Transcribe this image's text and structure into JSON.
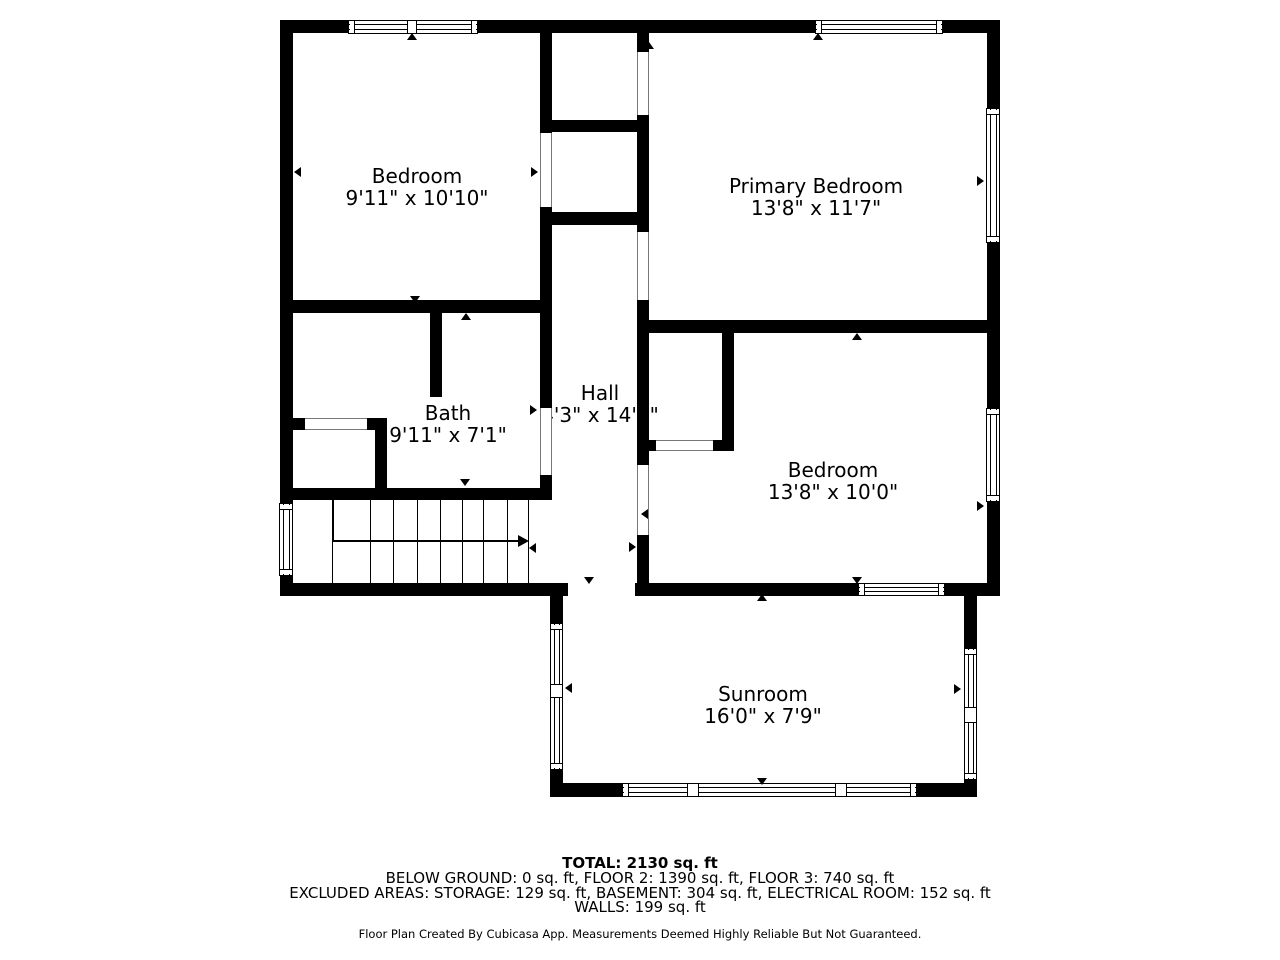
{
  "plan": {
    "rooms": [
      {
        "name": "Bedroom",
        "dims": "9'11\" x 10'10\""
      },
      {
        "name": "Primary Bedroom",
        "dims": "13'8\" x 11'7\""
      },
      {
        "name": "Bath",
        "dims": "9'11\" x 7'1\""
      },
      {
        "name": "Hall",
        "dims": "4'3\" x 14'6\""
      },
      {
        "name": "Bedroom",
        "dims": "13'8\" x 10'0\""
      },
      {
        "name": "Sunroom",
        "dims": "16'0\" x 7'9\""
      }
    ]
  },
  "summary": {
    "total": "TOTAL: 2130 sq. ft",
    "floors": "BELOW GROUND: 0 sq. ft, FLOOR 2: 1390 sq. ft, FLOOR 3: 740 sq. ft",
    "excluded": "EXCLUDED AREAS: STORAGE: 129 sq. ft, BASEMENT: 304 sq. ft, ELECTRICAL ROOM: 152 sq. ft",
    "walls": "WALLS: 199 sq. ft"
  },
  "credit": "Floor Plan Created By Cubicasa App. Measurements Deemed Highly Reliable But Not Guaranteed.",
  "colors": {
    "wall": "#000000",
    "background": "#ffffff",
    "text": "#000000"
  }
}
